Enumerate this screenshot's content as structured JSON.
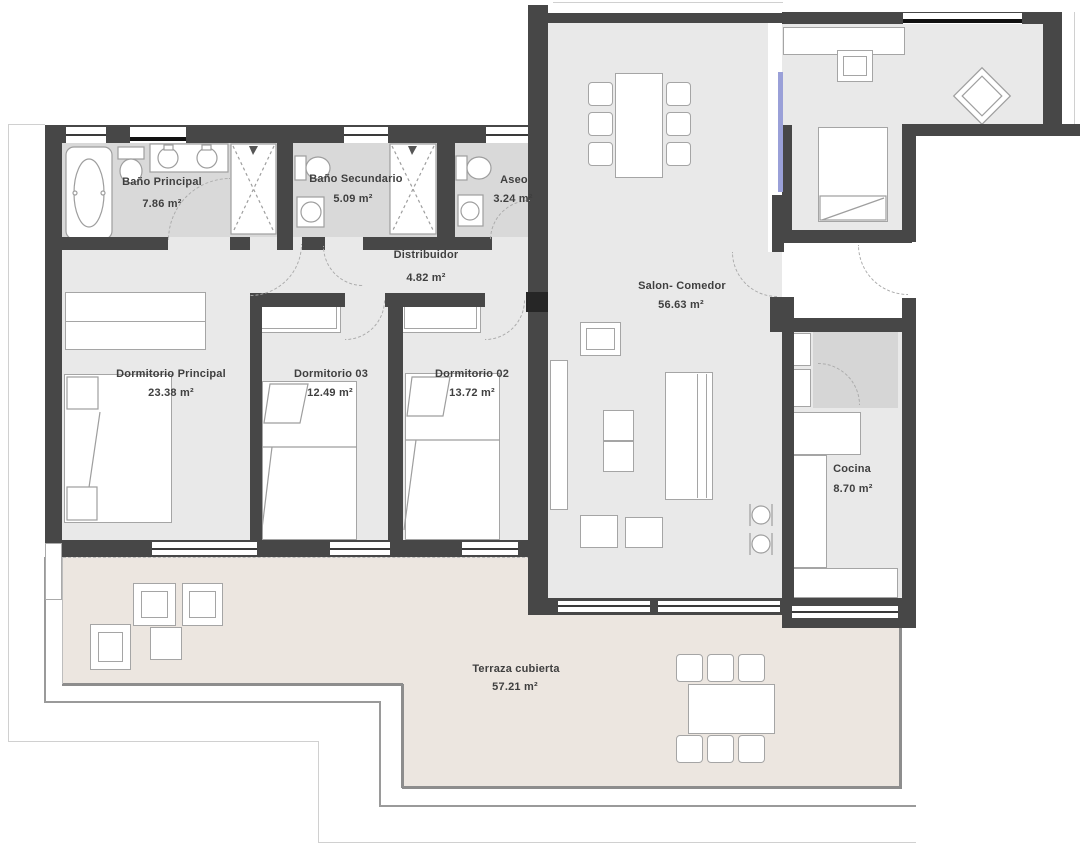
{
  "plan": {
    "rooms": [
      {
        "id": "bano-principal",
        "name": "Baño Principal",
        "area": "7.86 m²"
      },
      {
        "id": "bano-secundario",
        "name": "Baño Secundario",
        "area": "5.09 m²"
      },
      {
        "id": "aseo",
        "name": "Aseo",
        "area": "3.24 m²"
      },
      {
        "id": "distribuidor",
        "name": "Distribuidor",
        "area": "4.82 m²"
      },
      {
        "id": "salon-comedor",
        "name": "Salon- Comedor",
        "area": "56.63 m²"
      },
      {
        "id": "dormitorio-principal",
        "name": "Dormitorio Principal",
        "area": "23.38 m²"
      },
      {
        "id": "dormitorio-03",
        "name": "Dormitorio 03",
        "area": "12.49 m²"
      },
      {
        "id": "dormitorio-02",
        "name": "Dormitorio 02",
        "area": "13.72 m²"
      },
      {
        "id": "cocina",
        "name": "Cocina",
        "area": "8.70 m²"
      },
      {
        "id": "terraza",
        "name": "Terraza cubierta",
        "area": "57.21 m²"
      }
    ],
    "colors": {
      "wall": "#474747",
      "floor": "#e9e9e9",
      "wet_floor": "#d9d9d9",
      "closet_floor": "#d6d6d6",
      "terrace_floor": "#ece6e0",
      "accent_glass": "#9aa0d8"
    }
  }
}
